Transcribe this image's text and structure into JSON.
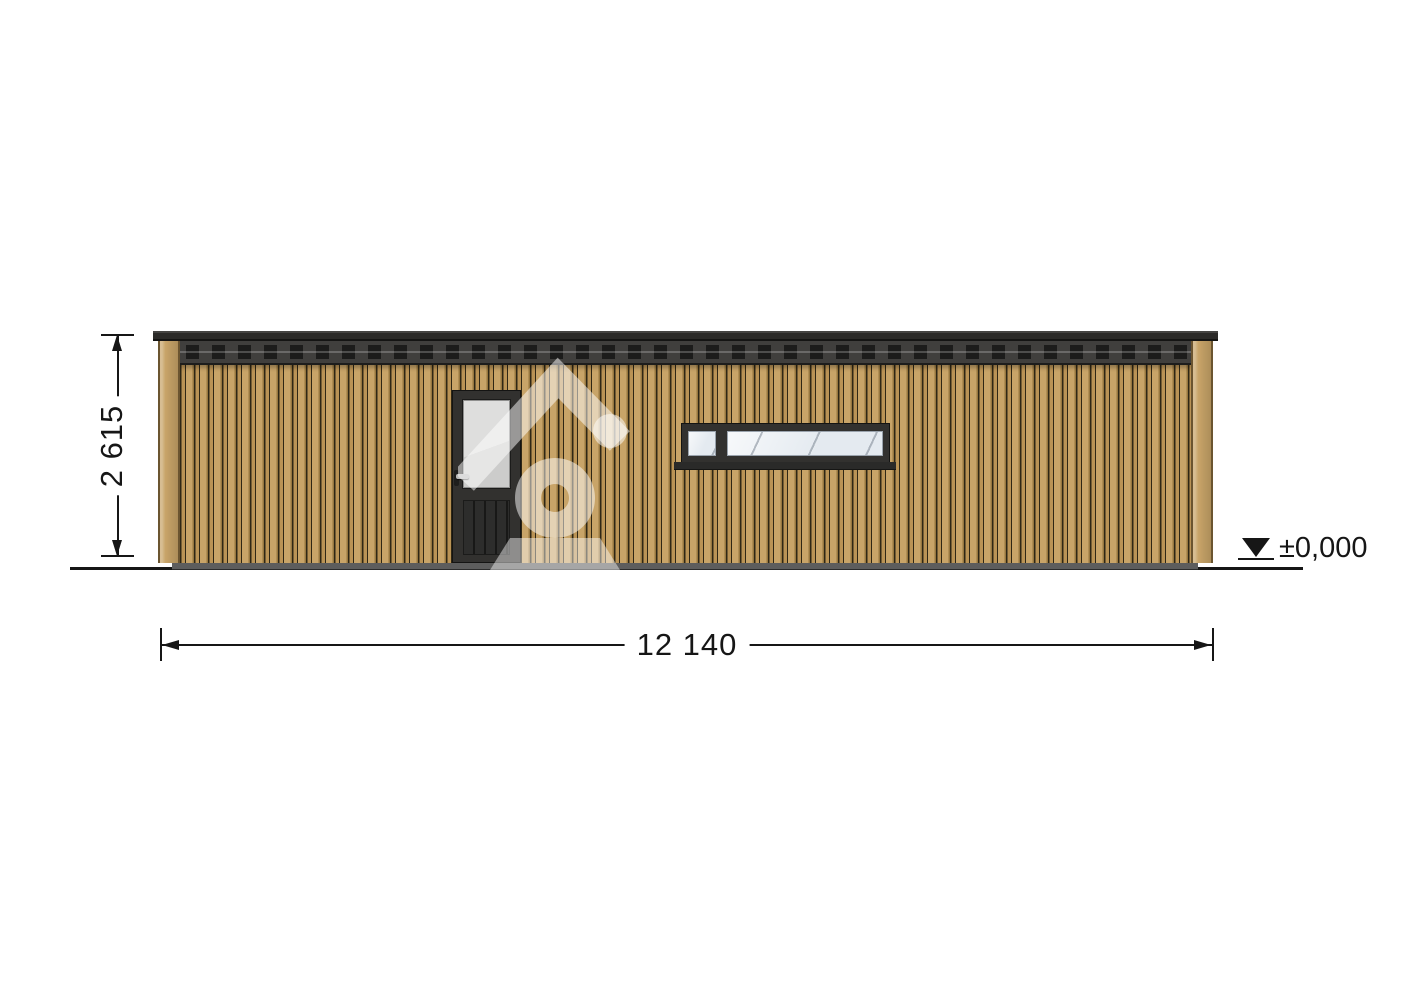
{
  "drawing": {
    "annotations": {
      "height": "2 615",
      "width": "12 140",
      "level": "±0,000"
    },
    "icons": {
      "level-marker": "filled-down-triangle",
      "watermark": "house-location-logo",
      "dimension-arrows": "filled-arrowheads"
    },
    "colors": {
      "ink": "#161616",
      "siding": "#c8a468",
      "siding-mid": "#ba9355",
      "siding-edge": "#97773f",
      "siding-groove": "#2f2715",
      "trim-edge": "#6b5530",
      "roof-cap": "#2b2a28",
      "fascia": "#403f3d",
      "fascia-block": "#1c1c1b",
      "frame": "#32312f",
      "door-glass": "#d6d6d5",
      "door-panel": "#2d2d2c",
      "window-glass": "#e4eaf0",
      "base": "#5d5d5d"
    }
  }
}
